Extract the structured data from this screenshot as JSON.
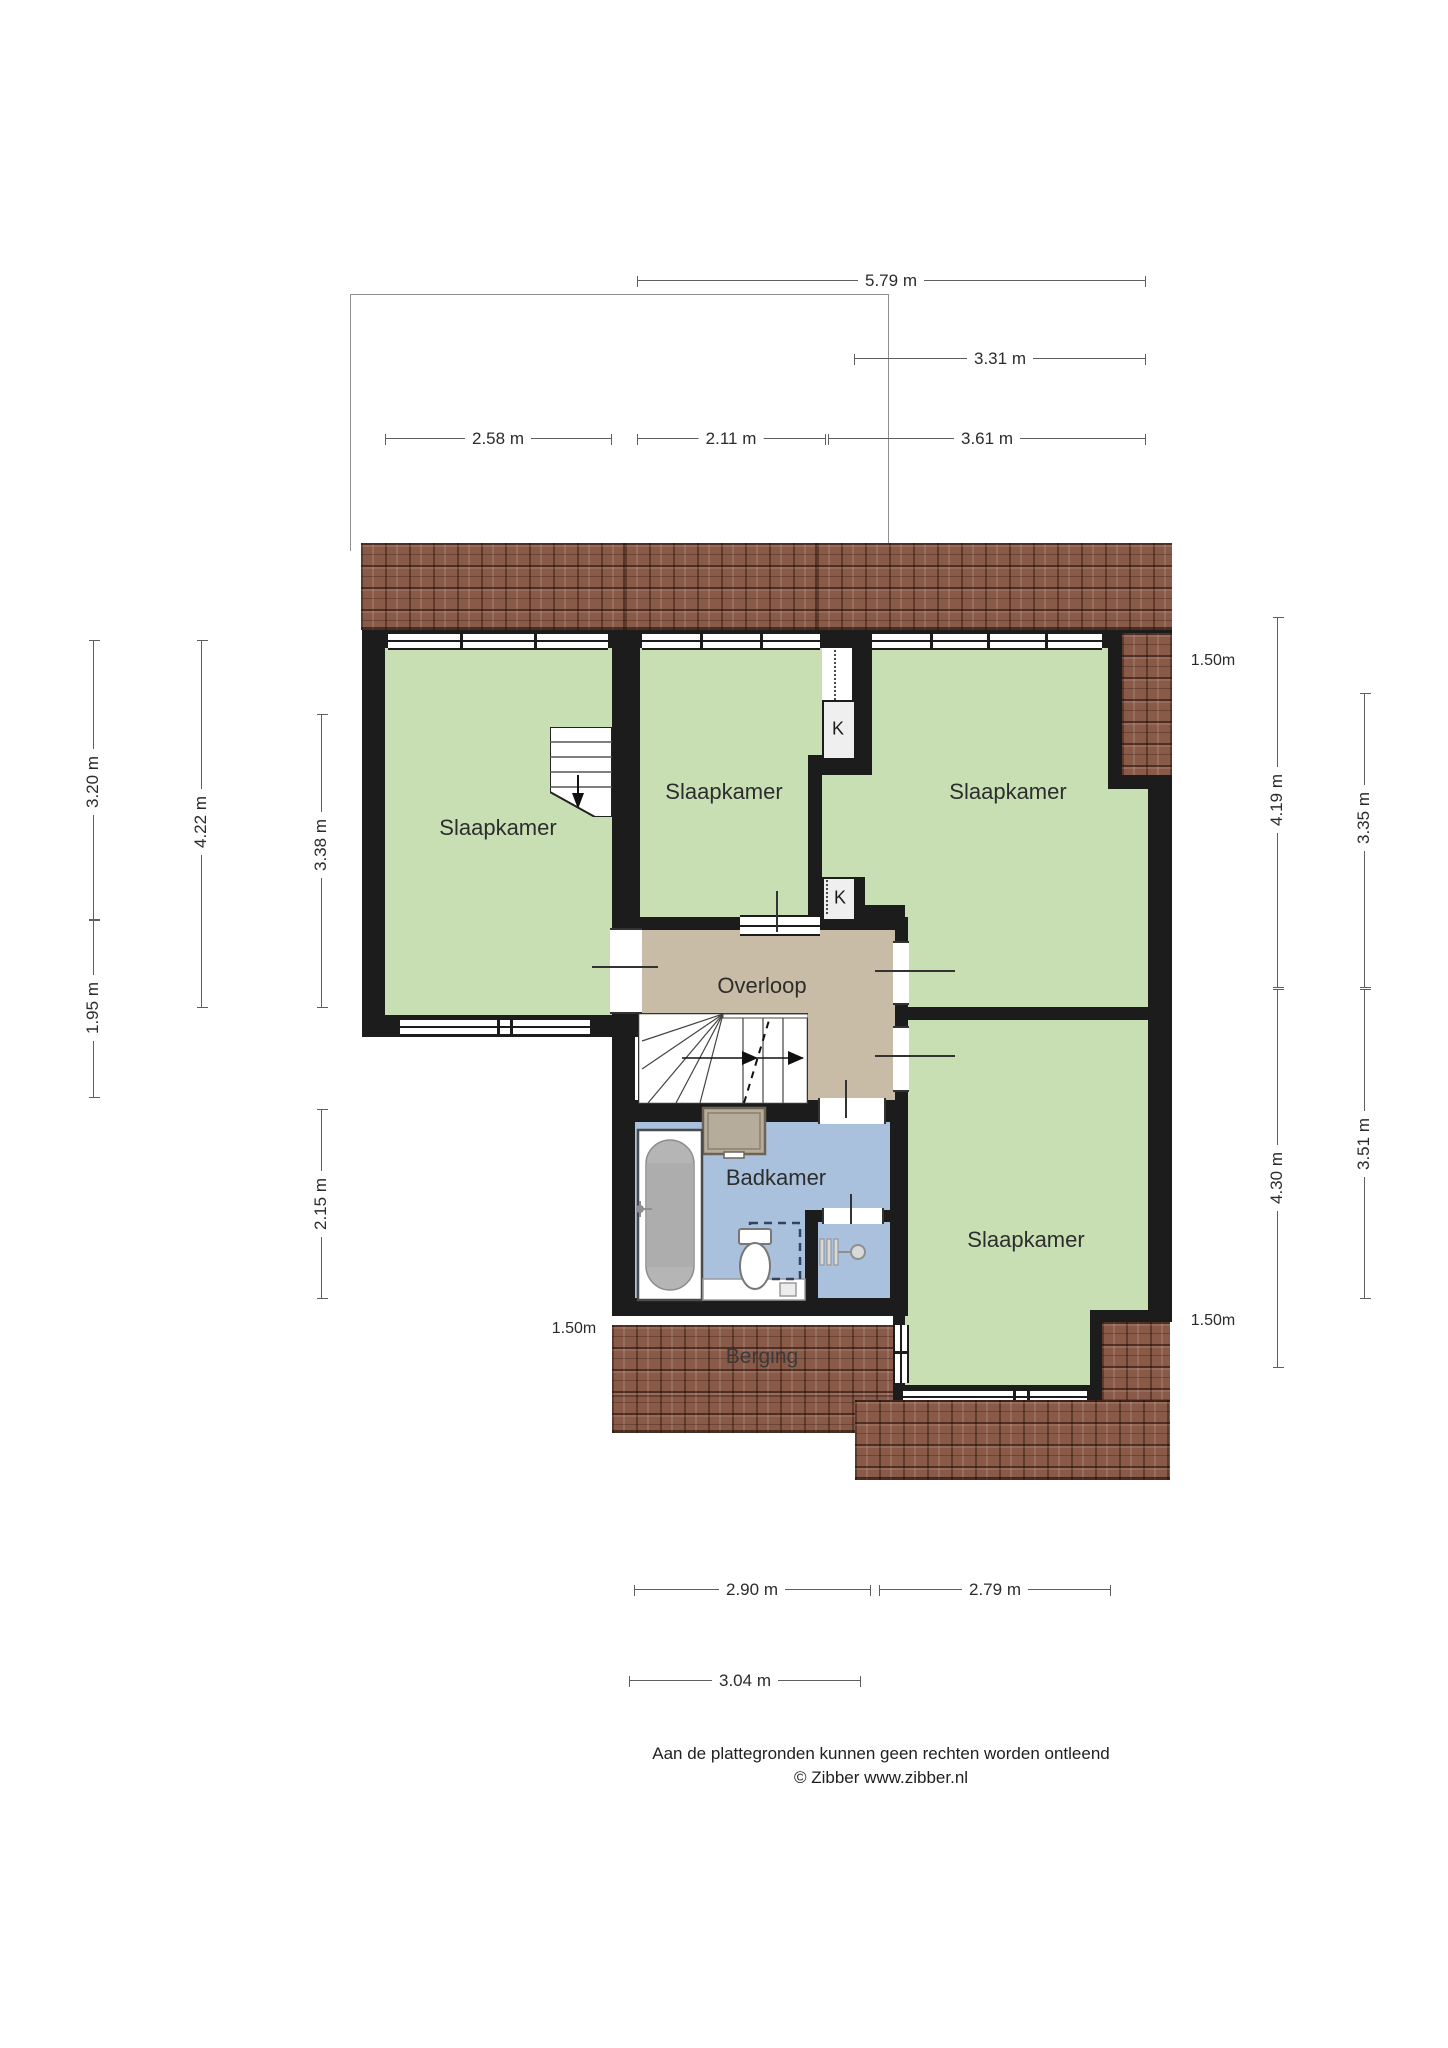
{
  "rooms": [
    {
      "id": "slaapkamer-1",
      "label": "Slaapkamer"
    },
    {
      "id": "slaapkamer-2",
      "label": "Slaapkamer"
    },
    {
      "id": "slaapkamer-3",
      "label": "Slaapkamer"
    },
    {
      "id": "slaapkamer-4",
      "label": "Slaapkamer"
    },
    {
      "id": "overloop",
      "label": "Overloop"
    },
    {
      "id": "badkamer",
      "label": "Badkamer"
    },
    {
      "id": "berging",
      "label": "Berging"
    }
  ],
  "closets": [
    {
      "label": "K"
    },
    {
      "label": "K"
    }
  ],
  "dimensions": {
    "top": [
      {
        "label": "5.79 m"
      },
      {
        "label": "3.31 m"
      },
      {
        "label": "2.58 m"
      },
      {
        "label": "2.11 m"
      },
      {
        "label": "3.61 m"
      }
    ],
    "left": [
      {
        "label": "3.20 m"
      },
      {
        "label": "1.95 m"
      },
      {
        "label": "4.22 m"
      },
      {
        "label": "3.38 m"
      },
      {
        "label": "2.15 m"
      }
    ],
    "right": [
      {
        "label": "4.19 m"
      },
      {
        "label": "3.35 m"
      },
      {
        "label": "4.30 m"
      },
      {
        "label": "3.51 m"
      }
    ],
    "bottom": [
      {
        "label": "2.90 m"
      },
      {
        "label": "2.79 m"
      },
      {
        "label": "3.04 m"
      }
    ],
    "headroom": [
      {
        "label": "1.50m"
      },
      {
        "label": "1.50m"
      },
      {
        "label": "1.50m"
      }
    ]
  },
  "footer": {
    "line1": "Aan de plattegronden kunnen geen rechten worden ontleend",
    "line2": "© Zibber www.zibber.nl"
  },
  "colors": {
    "room_green": "#c8dfb4",
    "hall_tan": "#c9bca6",
    "bath_blue": "#a9c1dc",
    "roof_brown": "#8a5a48",
    "wall_black": "#1c1c1c"
  }
}
